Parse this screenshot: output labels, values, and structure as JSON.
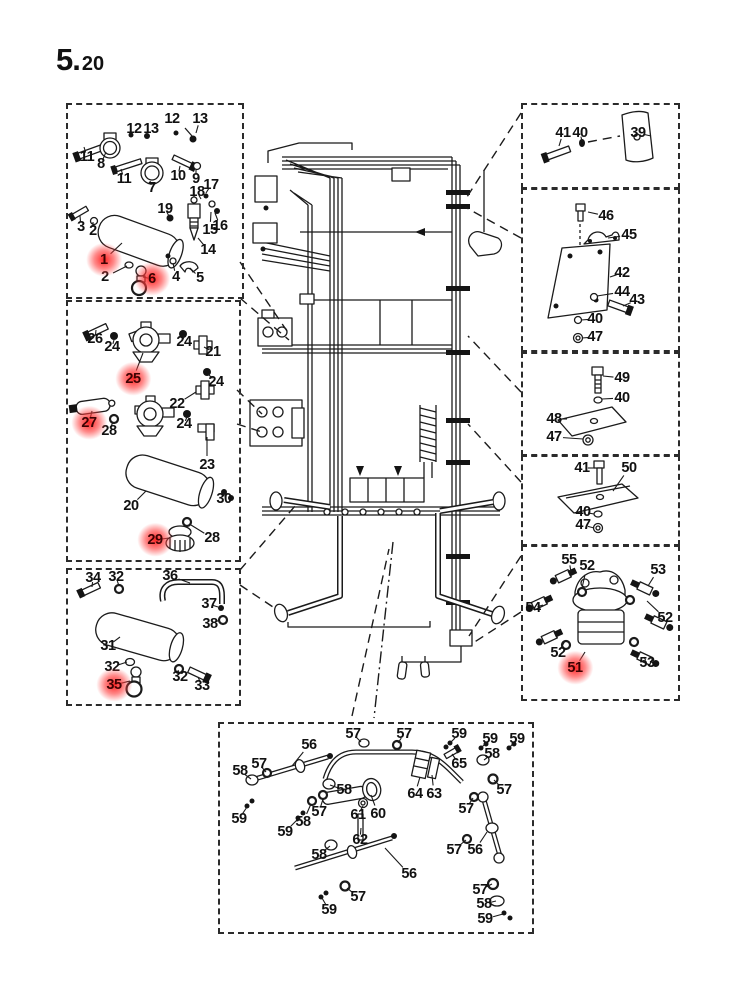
{
  "title": {
    "major": "5.",
    "minor": "20"
  },
  "colors": {
    "ink": "#1b1b1b",
    "highlight_glow": "#ff1f1f",
    "highlight_text": "#3d0202",
    "background": "#ffffff"
  },
  "boxes": [
    {
      "name": "detail-box-top-left",
      "x": 66,
      "y": 103,
      "w": 174,
      "h": 192,
      "labels": [
        {
          "t": "12",
          "x": 134,
          "y": 129
        },
        {
          "t": "13",
          "x": 151,
          "y": 129
        },
        {
          "t": "12",
          "x": 172,
          "y": 119
        },
        {
          "t": "13",
          "x": 200,
          "y": 119,
          "tx": 196,
          "ty": 133
        },
        {
          "t": "11",
          "x": 87,
          "y": 157,
          "tx": 84,
          "ty": 147
        },
        {
          "t": "8",
          "x": 101,
          "y": 164,
          "tx": 106,
          "ty": 152
        },
        {
          "t": "11",
          "x": 124,
          "y": 179,
          "tx": 121,
          "ty": 169
        },
        {
          "t": "7",
          "x": 152,
          "y": 188,
          "tx": 150,
          "ty": 181
        },
        {
          "t": "10",
          "x": 178,
          "y": 176,
          "tx": 180,
          "ty": 166
        },
        {
          "t": "9",
          "x": 196,
          "y": 179,
          "tx": 196,
          "ty": 169
        },
        {
          "t": "17",
          "x": 211,
          "y": 185,
          "tx": 206,
          "ty": 193
        },
        {
          "t": "18",
          "x": 197,
          "y": 192,
          "tx": 201,
          "ty": 199
        },
        {
          "t": "19",
          "x": 165,
          "y": 209,
          "tx": 169,
          "ty": 216
        },
        {
          "t": "3",
          "x": 81,
          "y": 227,
          "tx": 80,
          "ty": 216
        },
        {
          "t": "2",
          "x": 93,
          "y": 231,
          "tx": 93,
          "ty": 222
        },
        {
          "t": "16",
          "x": 220,
          "y": 226,
          "tx": 215,
          "ty": 213
        },
        {
          "t": "15",
          "x": 210,
          "y": 230,
          "tx": 211,
          "ty": 212
        },
        {
          "t": "14",
          "x": 208,
          "y": 250,
          "tx": 198,
          "ty": 238
        },
        {
          "t": "1",
          "x": 104,
          "y": 260,
          "hl": true,
          "tx": 122,
          "ty": 243
        },
        {
          "t": "2",
          "x": 105,
          "y": 277,
          "tx": 127,
          "ty": 266
        },
        {
          "t": "6",
          "x": 152,
          "y": 279,
          "hl": true,
          "tx": 143,
          "ty": 277
        },
        {
          "t": "4",
          "x": 176,
          "y": 277,
          "tx": 173,
          "ty": 263
        },
        {
          "t": "5",
          "x": 200,
          "y": 278,
          "tx": 190,
          "ty": 268
        }
      ]
    },
    {
      "name": "detail-box-mid-left",
      "x": 66,
      "y": 300,
      "w": 171,
      "h": 258,
      "labels": [
        {
          "t": "26",
          "x": 95,
          "y": 339,
          "tx": 96,
          "ty": 330
        },
        {
          "t": "24",
          "x": 112,
          "y": 347,
          "tx": 114,
          "ty": 340
        },
        {
          "t": "24",
          "x": 184,
          "y": 342,
          "tx": 183,
          "ty": 335
        },
        {
          "t": "21",
          "x": 213,
          "y": 352,
          "tx": 204,
          "ty": 347
        },
        {
          "t": "25",
          "x": 133,
          "y": 379,
          "hl": true,
          "tx": 143,
          "ty": 353
        },
        {
          "t": "24",
          "x": 216,
          "y": 382,
          "tx": 208,
          "ty": 374
        },
        {
          "t": "22",
          "x": 177,
          "y": 404,
          "tx": 196,
          "ty": 392
        },
        {
          "t": "27",
          "x": 89,
          "y": 423,
          "hl": true,
          "tx": 92,
          "ty": 411
        },
        {
          "t": "28",
          "x": 109,
          "y": 431,
          "tx": 113,
          "ty": 422
        },
        {
          "t": "24",
          "x": 184,
          "y": 424,
          "tx": 187,
          "ty": 417
        },
        {
          "t": "23",
          "x": 207,
          "y": 465,
          "tx": 207,
          "ty": 437
        },
        {
          "t": "20",
          "x": 131,
          "y": 506,
          "tx": 146,
          "ty": 491
        },
        {
          "t": "30",
          "x": 224,
          "y": 499,
          "tx": 224,
          "ty": 493
        },
        {
          "t": "29",
          "x": 155,
          "y": 540,
          "hl": true,
          "tx": 169,
          "ty": 538
        },
        {
          "t": "28",
          "x": 212,
          "y": 538,
          "tx": 191,
          "ty": 525
        }
      ]
    },
    {
      "name": "detail-box-bottom-left",
      "x": 66,
      "y": 568,
      "w": 171,
      "h": 134,
      "labels": [
        {
          "t": "34",
          "x": 93,
          "y": 578,
          "tx": 92,
          "ty": 587
        },
        {
          "t": "32",
          "x": 116,
          "y": 577,
          "tx": 119,
          "ty": 586
        },
        {
          "t": "36",
          "x": 170,
          "y": 576,
          "tx": 190,
          "ty": 583
        },
        {
          "t": "37",
          "x": 209,
          "y": 604,
          "tx": 218,
          "ty": 607
        },
        {
          "t": "38",
          "x": 210,
          "y": 624,
          "tx": 220,
          "ty": 620
        },
        {
          "t": "31",
          "x": 108,
          "y": 646,
          "tx": 120,
          "ty": 637
        },
        {
          "t": "32",
          "x": 112,
          "y": 667,
          "tx": 127,
          "ty": 662
        },
        {
          "t": "35",
          "x": 114,
          "y": 685,
          "hl": true,
          "tx": 130,
          "ty": 681
        },
        {
          "t": "32",
          "x": 180,
          "y": 677,
          "tx": 178,
          "ty": 670
        },
        {
          "t": "33",
          "x": 202,
          "y": 686,
          "tx": 198,
          "ty": 677
        }
      ]
    },
    {
      "name": "detail-box-right-1",
      "x": 521,
      "y": 103,
      "w": 155,
      "h": 82,
      "labels": [
        {
          "t": "41",
          "x": 563,
          "y": 133,
          "tx": 559,
          "ty": 146
        },
        {
          "t": "40",
          "x": 580,
          "y": 133,
          "tx": 582,
          "ty": 141
        },
        {
          "t": "39",
          "x": 638,
          "y": 133,
          "tx": 651,
          "ty": 136
        }
      ]
    },
    {
      "name": "detail-box-right-2",
      "x": 521,
      "y": 188,
      "w": 155,
      "h": 160,
      "labels": [
        {
          "t": "46",
          "x": 606,
          "y": 216,
          "tx": 588,
          "ty": 212
        },
        {
          "t": "45",
          "x": 629,
          "y": 235,
          "tx": 608,
          "ty": 238
        },
        {
          "t": "42",
          "x": 622,
          "y": 273,
          "tx": 610,
          "ty": 277
        },
        {
          "t": "44",
          "x": 622,
          "y": 292,
          "tx": 597,
          "ty": 296
        },
        {
          "t": "43",
          "x": 637,
          "y": 300,
          "tx": 623,
          "ty": 306
        },
        {
          "t": "40",
          "x": 595,
          "y": 319,
          "tx": 581,
          "ty": 320
        },
        {
          "t": "47",
          "x": 595,
          "y": 337,
          "tx": 582,
          "ty": 338
        }
      ]
    },
    {
      "name": "detail-box-right-3",
      "x": 521,
      "y": 352,
      "w": 155,
      "h": 100,
      "labels": [
        {
          "t": "49",
          "x": 622,
          "y": 378,
          "tx": 603,
          "ty": 376
        },
        {
          "t": "40",
          "x": 622,
          "y": 398,
          "tx": 602,
          "ty": 399
        },
        {
          "t": "48",
          "x": 554,
          "y": 419,
          "tx": 567,
          "ty": 419
        },
        {
          "t": "47",
          "x": 554,
          "y": 437,
          "tx": 583,
          "ty": 439
        }
      ]
    },
    {
      "name": "detail-box-right-4",
      "x": 521,
      "y": 455,
      "w": 155,
      "h": 87,
      "labels": [
        {
          "t": "41",
          "x": 582,
          "y": 468,
          "tx": 595,
          "ty": 468
        },
        {
          "t": "50",
          "x": 629,
          "y": 468,
          "tx": 613,
          "ty": 491
        },
        {
          "t": "40",
          "x": 583,
          "y": 512,
          "tx": 594,
          "ty": 514
        },
        {
          "t": "47",
          "x": 583,
          "y": 525,
          "tx": 594,
          "ty": 528
        }
      ]
    },
    {
      "name": "detail-box-right-5",
      "x": 521,
      "y": 545,
      "w": 155,
      "h": 152,
      "labels": [
        {
          "t": "55",
          "x": 569,
          "y": 560,
          "tx": 571,
          "ty": 572
        },
        {
          "t": "52",
          "x": 587,
          "y": 566,
          "tx": 582,
          "ty": 588
        },
        {
          "t": "53",
          "x": 658,
          "y": 570,
          "tx": 648,
          "ty": 586
        },
        {
          "t": "54",
          "x": 533,
          "y": 608,
          "tx": 543,
          "ty": 605
        },
        {
          "t": "52",
          "x": 665,
          "y": 618,
          "tx": 647,
          "ty": 601
        },
        {
          "t": "52",
          "x": 558,
          "y": 653,
          "tx": 565,
          "ty": 641
        },
        {
          "t": "51",
          "x": 575,
          "y": 668,
          "hl": true,
          "tx": 585,
          "ty": 652
        },
        {
          "t": "53",
          "x": 647,
          "y": 663,
          "tx": 644,
          "ty": 657
        }
      ]
    },
    {
      "name": "detail-box-bottom",
      "x": 218,
      "y": 722,
      "w": 312,
      "h": 208,
      "labels": [
        {
          "t": "57",
          "x": 353,
          "y": 734,
          "tx": 361,
          "ty": 742
        },
        {
          "t": "56",
          "x": 309,
          "y": 745,
          "tx": 292,
          "ty": 766
        },
        {
          "t": "57",
          "x": 404,
          "y": 734,
          "tx": 398,
          "ty": 743
        },
        {
          "t": "59",
          "x": 459,
          "y": 734,
          "tx": 450,
          "ty": 743
        },
        {
          "t": "59",
          "x": 490,
          "y": 739,
          "tx": 482,
          "ty": 747
        },
        {
          "t": "59",
          "x": 517,
          "y": 739,
          "tx": 510,
          "ty": 747
        },
        {
          "t": "58",
          "x": 492,
          "y": 754,
          "tx": 484,
          "ty": 760
        },
        {
          "t": "65",
          "x": 459,
          "y": 764,
          "tx": 452,
          "ty": 754
        },
        {
          "t": "58",
          "x": 240,
          "y": 771,
          "tx": 251,
          "ty": 779
        },
        {
          "t": "57",
          "x": 259,
          "y": 764,
          "tx": 266,
          "ty": 772
        },
        {
          "t": "58",
          "x": 344,
          "y": 790,
          "tx": 330,
          "ty": 785
        },
        {
          "t": "64",
          "x": 415,
          "y": 794,
          "tx": 420,
          "ty": 777
        },
        {
          "t": "63",
          "x": 434,
          "y": 794,
          "tx": 432,
          "ty": 775
        },
        {
          "t": "57",
          "x": 504,
          "y": 790,
          "tx": 494,
          "ty": 780
        },
        {
          "t": "59",
          "x": 239,
          "y": 819,
          "tx": 247,
          "ty": 807
        },
        {
          "t": "58",
          "x": 303,
          "y": 822,
          "tx": 311,
          "ty": 804
        },
        {
          "t": "57",
          "x": 319,
          "y": 812,
          "tx": 323,
          "ty": 799
        },
        {
          "t": "61",
          "x": 358,
          "y": 815,
          "tx": 363,
          "ty": 806
        },
        {
          "t": "60",
          "x": 378,
          "y": 814,
          "tx": 371,
          "ty": 795
        },
        {
          "t": "57",
          "x": 466,
          "y": 809,
          "tx": 473,
          "ty": 798
        },
        {
          "t": "59",
          "x": 285,
          "y": 832,
          "tx": 298,
          "ty": 819
        },
        {
          "t": "62",
          "x": 360,
          "y": 840,
          "tx": 361,
          "ty": 828
        },
        {
          "t": "57",
          "x": 454,
          "y": 850,
          "tx": 466,
          "ty": 840
        },
        {
          "t": "56",
          "x": 475,
          "y": 850,
          "tx": 487,
          "ty": 832
        },
        {
          "t": "58",
          "x": 319,
          "y": 855,
          "tx": 330,
          "ty": 846
        },
        {
          "t": "56",
          "x": 409,
          "y": 874,
          "tx": 385,
          "ty": 848
        },
        {
          "t": "57",
          "x": 358,
          "y": 897,
          "tx": 347,
          "ty": 888
        },
        {
          "t": "59",
          "x": 329,
          "y": 910,
          "tx": 322,
          "ty": 898
        },
        {
          "t": "57",
          "x": 480,
          "y": 890,
          "tx": 492,
          "ty": 884
        },
        {
          "t": "58",
          "x": 484,
          "y": 904,
          "tx": 496,
          "ty": 901
        },
        {
          "t": "59",
          "x": 485,
          "y": 919,
          "tx": 503,
          "ty": 914
        }
      ]
    }
  ]
}
